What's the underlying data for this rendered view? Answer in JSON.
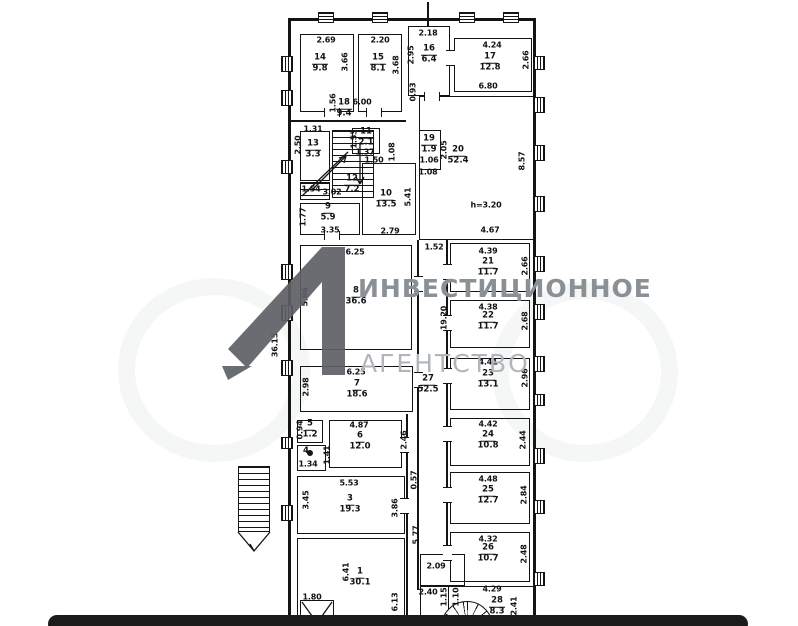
{
  "watermark": {
    "brand_line1": "ИНВЕСТИЦИОННОЕ",
    "brand_line2": "АГЕНТСТВО",
    "logo_color": "#5d6065",
    "text_color1": "#8b9095",
    "text_color2": "#b2b6ba"
  },
  "bottom_bar": {
    "color": "#1b1b1b"
  },
  "plan": {
    "note_height": "h=3.20",
    "rooms": [
      {
        "n": "14",
        "a": "9.8",
        "b": [
          300,
          34,
          54,
          78
        ],
        "l": [
          320,
          64
        ]
      },
      {
        "n": "15",
        "a": "8.1",
        "b": [
          358,
          34,
          44,
          78
        ],
        "l": [
          378,
          64
        ]
      },
      {
        "n": "16",
        "a": "6.4",
        "b": [
          408,
          26,
          42,
          70
        ],
        "l": [
          429,
          55
        ]
      },
      {
        "n": "17",
        "a": "12.8",
        "b": [
          454,
          38,
          78,
          54
        ],
        "l": [
          490,
          63
        ]
      },
      {
        "n": "18",
        "a": "9.4",
        "b": null,
        "l": [
          344,
          109
        ]
      },
      {
        "n": "13",
        "a": "3.3",
        "b": [
          300,
          131,
          30,
          50
        ],
        "l": [
          313,
          150
        ]
      },
      {
        "n": "11",
        "a": "2.1",
        "b": [
          352,
          128,
          28,
          26
        ],
        "l": [
          366,
          138
        ]
      },
      {
        "n": "12",
        "a": "7.2",
        "b": null,
        "l": [
          352,
          185
        ]
      },
      {
        "n": "10",
        "a": "13.5",
        "b": [
          362,
          163,
          54,
          72
        ],
        "l": [
          386,
          200
        ]
      },
      {
        "n": "9",
        "a": "5.9",
        "b": [
          300,
          203,
          60,
          32
        ],
        "l": [
          328,
          213
        ]
      },
      {
        "n": "19",
        "a": "1.9",
        "b": [
          419,
          130,
          22,
          40
        ],
        "l": [
          429,
          145
        ]
      },
      {
        "n": "20",
        "a": "52.4",
        "b": [
          419,
          96,
          116,
          144
        ],
        "l": [
          458,
          156
        ]
      },
      {
        "n": "8",
        "a": "36.6",
        "b": [
          300,
          245,
          112,
          105
        ],
        "l": [
          356,
          297
        ]
      },
      {
        "n": "21",
        "a": "11.7",
        "b": [
          450,
          243,
          80,
          49
        ],
        "l": [
          488,
          268
        ]
      },
      {
        "n": "22",
        "a": "11.7",
        "b": [
          450,
          300,
          80,
          48
        ],
        "l": [
          488,
          322
        ]
      },
      {
        "n": "23",
        "a": "13.1",
        "b": [
          450,
          358,
          80,
          52
        ],
        "l": [
          488,
          380
        ]
      },
      {
        "n": "7",
        "a": "18.6",
        "b": [
          300,
          366,
          113,
          46
        ],
        "l": [
          357,
          390
        ]
      },
      {
        "n": "27",
        "a": "52.5",
        "b": null,
        "l": [
          428,
          385
        ]
      },
      {
        "n": "5",
        "a": "1.2",
        "b": [
          297,
          420,
          26,
          23
        ],
        "l": [
          310,
          430
        ]
      },
      {
        "n": "4",
        "a": "",
        "b": [
          297,
          445,
          29,
          26
        ],
        "l": [
          306,
          452
        ]
      },
      {
        "n": "6",
        "a": "12.0",
        "b": [
          329,
          420,
          73,
          48
        ],
        "l": [
          360,
          442
        ]
      },
      {
        "n": "3",
        "a": "19.3",
        "b": [
          297,
          476,
          108,
          58
        ],
        "l": [
          350,
          505
        ]
      },
      {
        "n": "1",
        "a": "30.1",
        "b": [
          297,
          538,
          108,
          80
        ],
        "l": [
          360,
          578
        ]
      },
      {
        "n": "24",
        "a": "10.8",
        "b": [
          450,
          418,
          80,
          48
        ],
        "l": [
          488,
          441
        ]
      },
      {
        "n": "25",
        "a": "12.7",
        "b": [
          450,
          472,
          80,
          52
        ],
        "l": [
          488,
          496
        ]
      },
      {
        "n": "26",
        "a": "10.7",
        "b": [
          450,
          532,
          80,
          50
        ],
        "l": [
          488,
          554
        ]
      },
      {
        "n": "28",
        "a": "8.3",
        "b": [
          448,
          586,
          86,
          40
        ],
        "l": [
          497,
          607
        ]
      }
    ],
    "extra_boxes": [
      [
        420,
        554,
        45,
        32
      ],
      [
        420,
        586,
        29,
        40
      ],
      [
        300,
        600,
        34,
        26
      ]
    ],
    "labels": [
      {
        "t": "2.69",
        "x": 326,
        "y": 40
      },
      {
        "t": "3.66",
        "x": 345,
        "y": 62,
        "v": 1
      },
      {
        "t": "2.20",
        "x": 380,
        "y": 40
      },
      {
        "t": "3.68",
        "x": 396,
        "y": 65,
        "v": 1
      },
      {
        "t": "2.18",
        "x": 428,
        "y": 33
      },
      {
        "t": "2.95",
        "x": 411,
        "y": 55,
        "v": 1
      },
      {
        "t": "4.24",
        "x": 492,
        "y": 45
      },
      {
        "t": "2.66",
        "x": 526,
        "y": 60,
        "v": 1
      },
      {
        "t": "6.00",
        "x": 362,
        "y": 102
      },
      {
        "t": "1.56",
        "x": 333,
        "y": 103,
        "v": 1
      },
      {
        "t": "0.93",
        "x": 413,
        "y": 92,
        "v": 1
      },
      {
        "t": "6.80",
        "x": 488,
        "y": 86
      },
      {
        "t": "8.57",
        "x": 522,
        "y": 161,
        "v": 1
      },
      {
        "t": "h=3.20",
        "x": 486,
        "y": 205
      },
      {
        "t": "4.67",
        "x": 490,
        "y": 230
      },
      {
        "t": "1.31",
        "x": 313,
        "y": 129
      },
      {
        "t": "2.50",
        "x": 298,
        "y": 145,
        "v": 1
      },
      {
        "t": "1.54",
        "x": 311,
        "y": 189
      },
      {
        "t": "3.02",
        "x": 332,
        "y": 192
      },
      {
        "t": "1.37",
        "x": 365,
        "y": 152
      },
      {
        "t": "1.53",
        "x": 354,
        "y": 139,
        "v": 1
      },
      {
        "t": "1.08",
        "x": 392,
        "y": 152,
        "v": 1
      },
      {
        "t": "1.50",
        "x": 374,
        "y": 160
      },
      {
        "t": "5.41",
        "x": 408,
        "y": 197,
        "v": 1
      },
      {
        "t": "2.79",
        "x": 390,
        "y": 231
      },
      {
        "t": "3.35",
        "x": 330,
        "y": 230
      },
      {
        "t": "1.77",
        "x": 303,
        "y": 217,
        "v": 1
      },
      {
        "t": "1.06",
        "x": 429,
        "y": 160
      },
      {
        "t": "1.08",
        "x": 428,
        "y": 172
      },
      {
        "t": "2.05",
        "x": 444,
        "y": 150,
        "v": 1
      },
      {
        "t": "1.52",
        "x": 434,
        "y": 247
      },
      {
        "t": "19.20",
        "x": 444,
        "y": 318,
        "v": 1
      },
      {
        "t": "36.15",
        "x": 275,
        "y": 345,
        "v": 1
      },
      {
        "t": "6.25",
        "x": 355,
        "y": 252
      },
      {
        "t": "5.86",
        "x": 305,
        "y": 297,
        "v": 1
      },
      {
        "t": "4.39",
        "x": 488,
        "y": 251
      },
      {
        "t": "2.66",
        "x": 525,
        "y": 266,
        "v": 1
      },
      {
        "t": "4.38",
        "x": 488,
        "y": 307
      },
      {
        "t": "2.68",
        "x": 525,
        "y": 321,
        "v": 1
      },
      {
        "t": "4.41",
        "x": 488,
        "y": 362
      },
      {
        "t": "2.96",
        "x": 525,
        "y": 378,
        "v": 1
      },
      {
        "t": "6.25",
        "x": 356,
        "y": 372
      },
      {
        "t": "2.98",
        "x": 306,
        "y": 387,
        "v": 1
      },
      {
        "t": "0.94",
        "x": 300,
        "y": 430,
        "v": 1
      },
      {
        "t": "4.87",
        "x": 359,
        "y": 425
      },
      {
        "t": "2.46",
        "x": 404,
        "y": 440,
        "v": 1
      },
      {
        "t": "1.34",
        "x": 308,
        "y": 464
      },
      {
        "t": "1.41",
        "x": 327,
        "y": 455,
        "v": 1
      },
      {
        "t": "5.53",
        "x": 349,
        "y": 483
      },
      {
        "t": "3.45",
        "x": 306,
        "y": 500,
        "v": 1
      },
      {
        "t": "3.86",
        "x": 395,
        "y": 508,
        "v": 1
      },
      {
        "t": "0.57",
        "x": 414,
        "y": 480,
        "v": 1
      },
      {
        "t": "5.77",
        "x": 416,
        "y": 535,
        "v": 1
      },
      {
        "t": "4.42",
        "x": 488,
        "y": 424
      },
      {
        "t": "2.44",
        "x": 523,
        "y": 440,
        "v": 1
      },
      {
        "t": "4.48",
        "x": 488,
        "y": 479
      },
      {
        "t": "2.84",
        "x": 524,
        "y": 495,
        "v": 1
      },
      {
        "t": "4.32",
        "x": 488,
        "y": 539
      },
      {
        "t": "2.48",
        "x": 524,
        "y": 554,
        "v": 1
      },
      {
        "t": "6.41",
        "x": 346,
        "y": 572,
        "v": 1
      },
      {
        "t": "1.80",
        "x": 312,
        "y": 597
      },
      {
        "t": "6.13",
        "x": 395,
        "y": 602,
        "v": 1
      },
      {
        "t": "2.09",
        "x": 436,
        "y": 566
      },
      {
        "t": "2.40",
        "x": 428,
        "y": 592
      },
      {
        "t": "1.15",
        "x": 444,
        "y": 597,
        "v": 1
      },
      {
        "t": "1.10",
        "x": 456,
        "y": 597,
        "v": 1
      },
      {
        "t": "4.29",
        "x": 492,
        "y": 589
      },
      {
        "t": "2.41",
        "x": 514,
        "y": 606,
        "v": 1
      }
    ],
    "walls": [
      [
        288,
        18,
        248,
        3
      ],
      [
        288,
        18,
        3,
        600
      ],
      [
        533,
        18,
        3,
        600
      ],
      [
        417,
        240,
        2,
        350
      ],
      [
        446,
        240,
        2,
        316
      ],
      [
        406,
        414,
        2,
        204
      ],
      [
        288,
        120,
        118,
        2
      ],
      [
        427,
        2,
        2,
        24
      ]
    ],
    "windows": [
      [
        318,
        12,
        16,
        11
      ],
      [
        372,
        12,
        16,
        11
      ],
      [
        459,
        12,
        16,
        11
      ],
      [
        503,
        12,
        16,
        11
      ],
      [
        281,
        56,
        12,
        16
      ],
      [
        281,
        90,
        12,
        16
      ],
      [
        281,
        160,
        12,
        14
      ],
      [
        281,
        264,
        12,
        16
      ],
      [
        281,
        305,
        12,
        16
      ],
      [
        281,
        360,
        12,
        16
      ],
      [
        281,
        437,
        12,
        12
      ],
      [
        281,
        505,
        12,
        16
      ],
      [
        533,
        56,
        12,
        14
      ],
      [
        533,
        97,
        12,
        16
      ],
      [
        533,
        145,
        12,
        16
      ],
      [
        533,
        196,
        12,
        16
      ],
      [
        533,
        256,
        12,
        16
      ],
      [
        533,
        304,
        12,
        16
      ],
      [
        533,
        356,
        12,
        16
      ],
      [
        533,
        394,
        12,
        12
      ],
      [
        533,
        448,
        12,
        16
      ],
      [
        533,
        500,
        12,
        14
      ],
      [
        533,
        572,
        12,
        14
      ]
    ],
    "doors": [
      [
        414,
        276,
        "v"
      ],
      [
        443,
        264,
        "v"
      ],
      [
        443,
        315,
        "v"
      ],
      [
        443,
        368,
        "v"
      ],
      [
        443,
        426,
        "v"
      ],
      [
        443,
        487,
        "v"
      ],
      [
        443,
        545,
        "v"
      ],
      [
        414,
        372,
        "v"
      ],
      [
        400,
        437,
        "v"
      ],
      [
        400,
        498,
        "v"
      ],
      [
        446,
        50,
        "v"
      ],
      [
        366,
        108,
        "h"
      ],
      [
        324,
        108,
        "h"
      ],
      [
        424,
        92,
        "h"
      ],
      [
        324,
        231,
        "h"
      ]
    ]
  }
}
